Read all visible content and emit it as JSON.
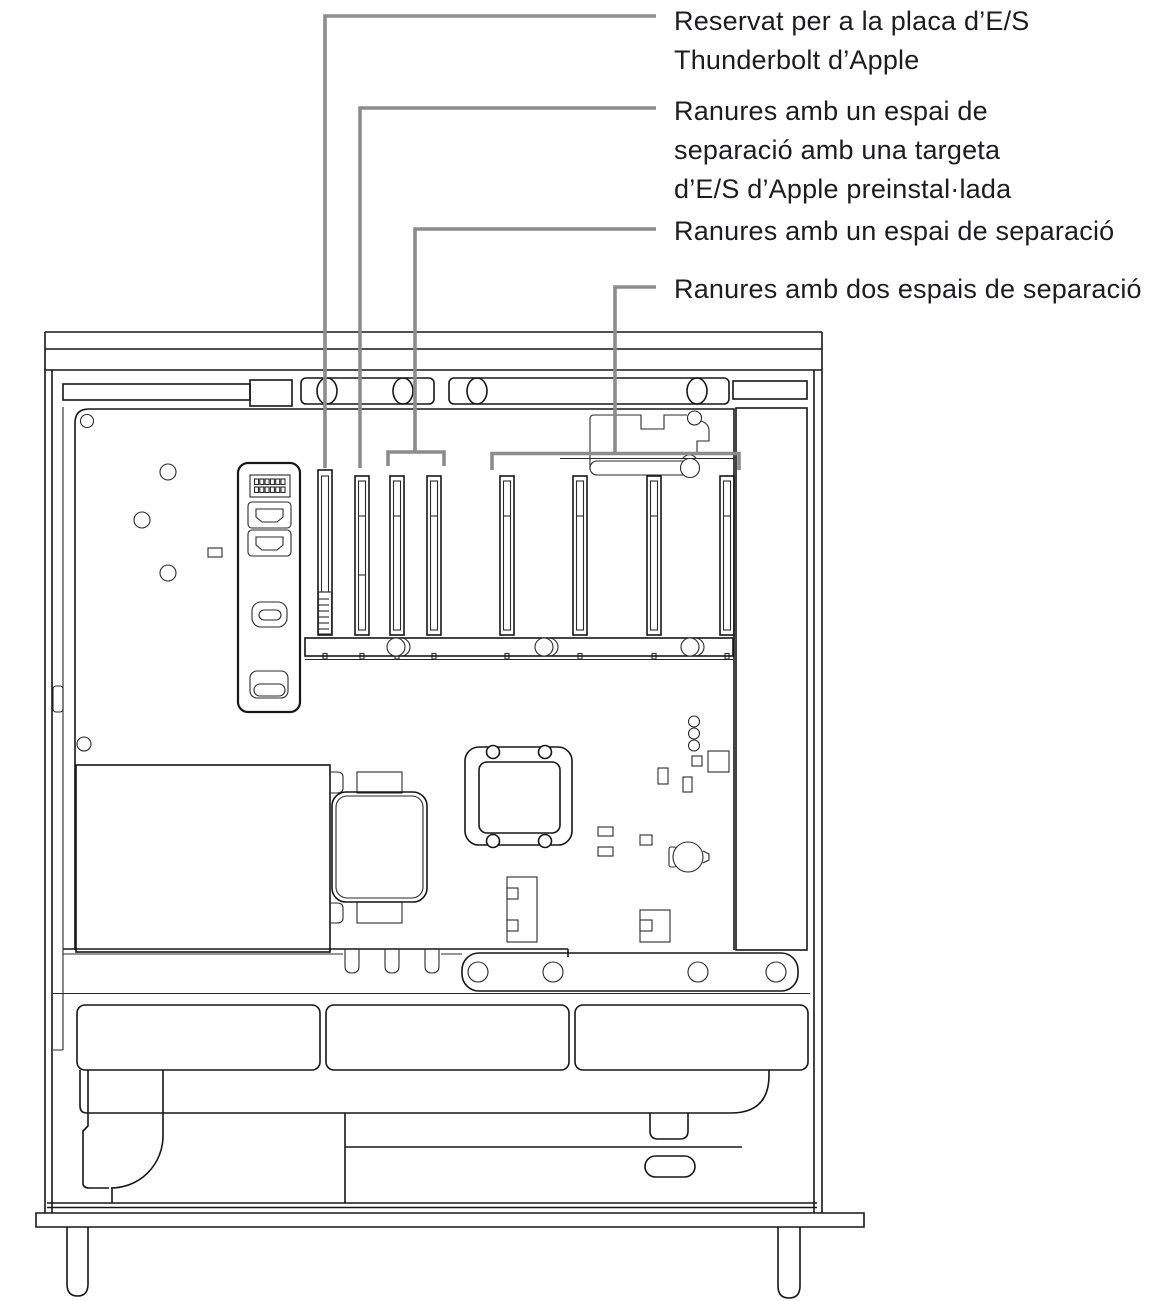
{
  "figure": {
    "labels": [
      {
        "id": "thunderbolt-io-board",
        "lines": [
          "Reservat per a la placa d’E/S",
          "Thunderbolt d’Apple"
        ]
      },
      {
        "id": "single-wide-slots-with-card",
        "lines": [
          "Ranures amb un espai de",
          "separació amb una targeta",
          "d’E/S d’Apple preinstal·lada"
        ]
      },
      {
        "id": "single-wide-slots",
        "lines": [
          "Ranures amb un espai de separació"
        ]
      },
      {
        "id": "double-wide-slots",
        "lines": [
          "Ranures amb dos espais de separació"
        ]
      }
    ],
    "colors": {
      "background": "#ffffff",
      "ink": "#161616",
      "callout": "#8c8c8c",
      "text": "#1d1d1f"
    }
  }
}
